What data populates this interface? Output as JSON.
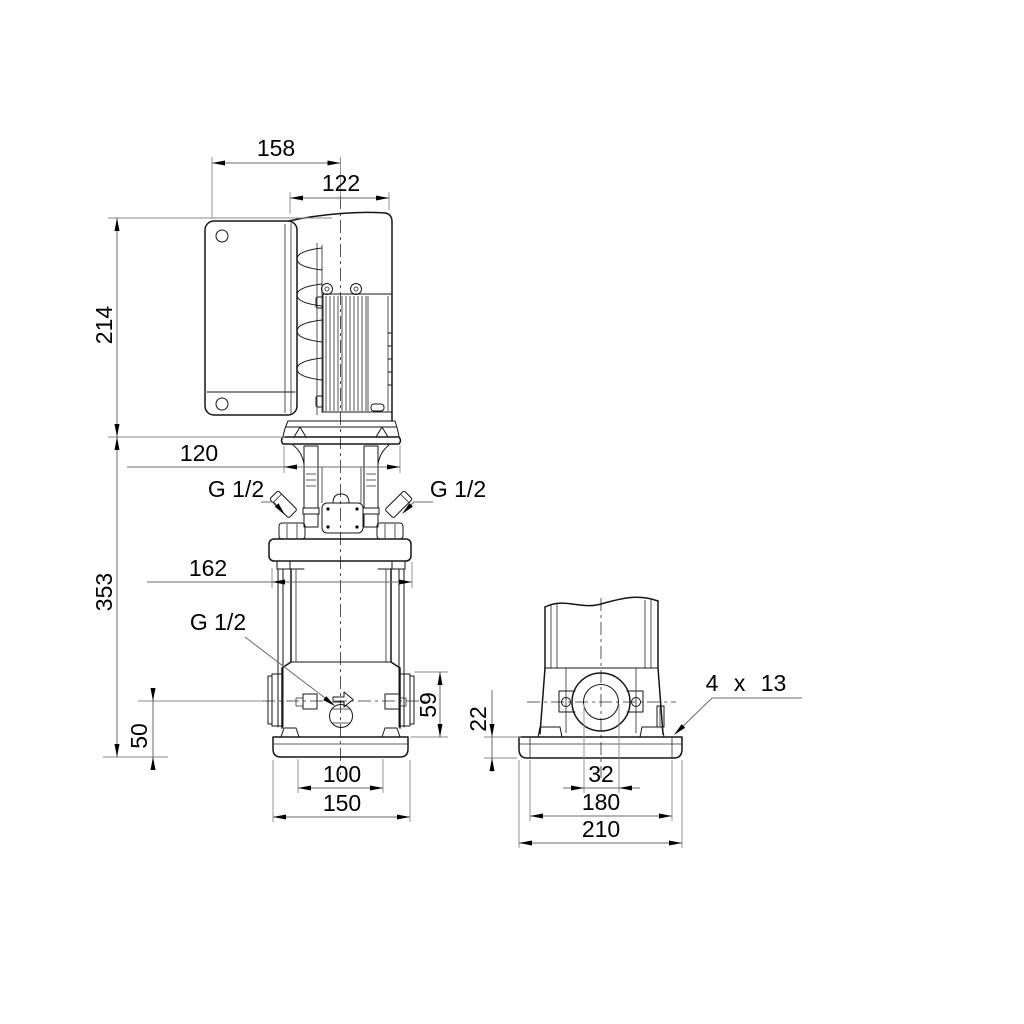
{
  "drawing": {
    "front_view": {
      "dims": {
        "converter_width": "158",
        "motor_diameter": "122",
        "motor_height": "214",
        "coupling_width": "120",
        "pump_height": "353",
        "pump_width": "162",
        "gauge_port_left": "G 1/2",
        "gauge_port_right": "G 1/2",
        "drain_port": "G 1/2",
        "port_height": "59",
        "port_centerline_height": "50",
        "base_hole_spacing": "100",
        "base_width": "150"
      }
    },
    "side_view": {
      "dims": {
        "baseplate_thickness": "22",
        "port_bore": "32",
        "bolt_spacing": "180",
        "baseplate_length": "210",
        "bolt_holes": "4 x 13"
      }
    },
    "colors": {
      "line": "#161616",
      "dimension": "#6b6b6b",
      "background": "#ffffff",
      "text": "#000000"
    }
  }
}
